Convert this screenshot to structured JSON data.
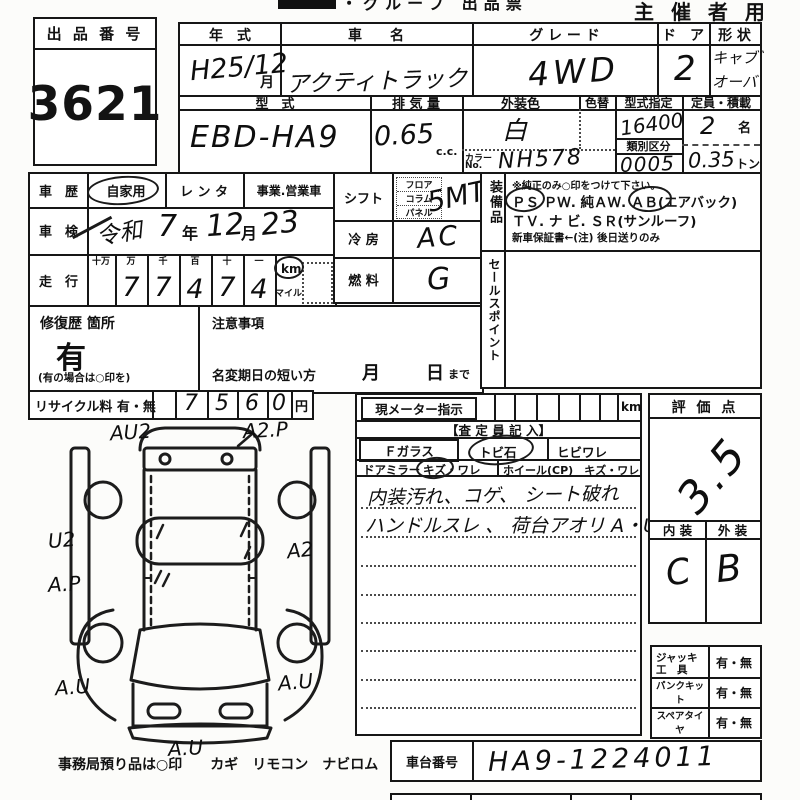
{
  "header": {
    "title_partial": "・グループ 出品票",
    "organizer": "主 催 者 用"
  },
  "lot": {
    "label": "出 品 番 号",
    "number": "3621"
  },
  "row1": {
    "year_label": "年　式",
    "year_value": "H25/12",
    "year_unit": "月",
    "name_label": "車　　名",
    "name_value": "アクティトラック",
    "grade_label": "グ レ ー ド",
    "grade_value": "4WD",
    "door_label": "ド　ア",
    "door_value": "2",
    "shape_label": "形 状",
    "shape_line1": "キャブ゛",
    "shape_line2": "オーバ"
  },
  "row2": {
    "model_label": "型　式",
    "model_value": "EBD-HA9",
    "disp_label": "排 気 量",
    "disp_value": "0.65",
    "disp_unit": "c.c.",
    "color_label": "外装色",
    "color_value": "白",
    "color_change_label": "色替",
    "color_no_label1": "カラー",
    "color_no_label2": "No.",
    "color_no_value": "NH578",
    "type_label": "型式指定",
    "type_value": "16400",
    "class_label": "類別区分",
    "class_value": "0005",
    "cap_label": "定員・積載",
    "cap_value": "2",
    "cap_unit": "名",
    "load_value": "0.35",
    "load_unit": "トン"
  },
  "history": {
    "label": "車　歴",
    "private": "自家用",
    "rental": "レ ン タ",
    "business": "事業.営業車",
    "inspection_label": "車　検",
    "era": "令和",
    "insp_year": "7",
    "year_unit": "年",
    "insp_month": "12",
    "month_unit": "月",
    "insp_day": "23",
    "mileage_label": "走　行",
    "digit_headers": [
      "十万",
      "万",
      "千",
      "百",
      "十",
      "一"
    ],
    "digits": [
      "",
      "7",
      "7",
      "4",
      "7",
      "4"
    ],
    "unit_km": "km",
    "unit_mile": "マイル"
  },
  "equip": {
    "shift_label": "シフト",
    "shift_opt1": "フロア",
    "shift_opt2": "コラム",
    "shift_opt3": "パネル",
    "shift_value": "5MT",
    "ac_label": "冷 房",
    "ac_value": "AC",
    "fuel_label": "燃 料",
    "fuel_value": "G"
  },
  "equipment": {
    "label": "装備品",
    "note": "※純正のみ○印をつけて下さい。",
    "ps": "ＰＳ",
    "line1_mid": "ＰＷ. 純ＡＷ.",
    "ab": "ＡＢ",
    "airbag": "(エアバック)",
    "line2": "ＴＶ. ナ ビ. ＳＲ(サンルーフ)",
    "line3": "新車保証書←(注) 後日送りのみ"
  },
  "sales": {
    "label": "セールスポイント"
  },
  "repair": {
    "label": "修復歴 箇所",
    "value": "有",
    "note": "(有の場合は○印を)"
  },
  "caution": {
    "label": "注意事項",
    "rename": "名変期日の短い方",
    "month": "月",
    "day": "日",
    "made": "まで"
  },
  "recycle": {
    "label": "リサイクル料 有・無",
    "digits": [
      "7",
      "5",
      "6",
      "0"
    ],
    "unit": "円"
  },
  "meter": {
    "label": "現メーター指示",
    "unit": "km",
    "assessor": "【査 定 員 記 入】",
    "fglass": "Ｆガラス",
    "stone": "トビ石",
    "crack": "ヒビワレ",
    "mirror": "ドアミラー",
    "mirror_dmg": "キズ・ワレ",
    "wheel": "ホイール(CP)　キズ・ワレ",
    "note1": "内装汚れ、コゲ、 シート破れ",
    "note2": "ハンドルスレ 、 荷台アオリ A・U"
  },
  "score": {
    "label": "評 価 点",
    "value": "3.5",
    "interior_label": "内 装",
    "exterior_label": "外 装",
    "interior": "C",
    "exterior": "B"
  },
  "tools": {
    "jack1": "ジャッキ",
    "jack2": "工　具",
    "jack_opt": "有・無",
    "puncture": "パンクキット",
    "puncture_opt": "有・無",
    "spare": "スペアタイヤ",
    "spare_opt": "有・無"
  },
  "chassis": {
    "label": "車台番号",
    "value": "HA9-1224011"
  },
  "diagram": {
    "l_au2": "AU2",
    "l_a2p": "A2.P",
    "l_u2": "U2",
    "l_a2": "A2",
    "l_ap": "A.P",
    "l_au_left": "A.U",
    "l_au_right": "A.U",
    "l_au_bottom": "A.U",
    "footer": "事務局預り品は○印　　カギ　リモコン　ナビロム"
  }
}
